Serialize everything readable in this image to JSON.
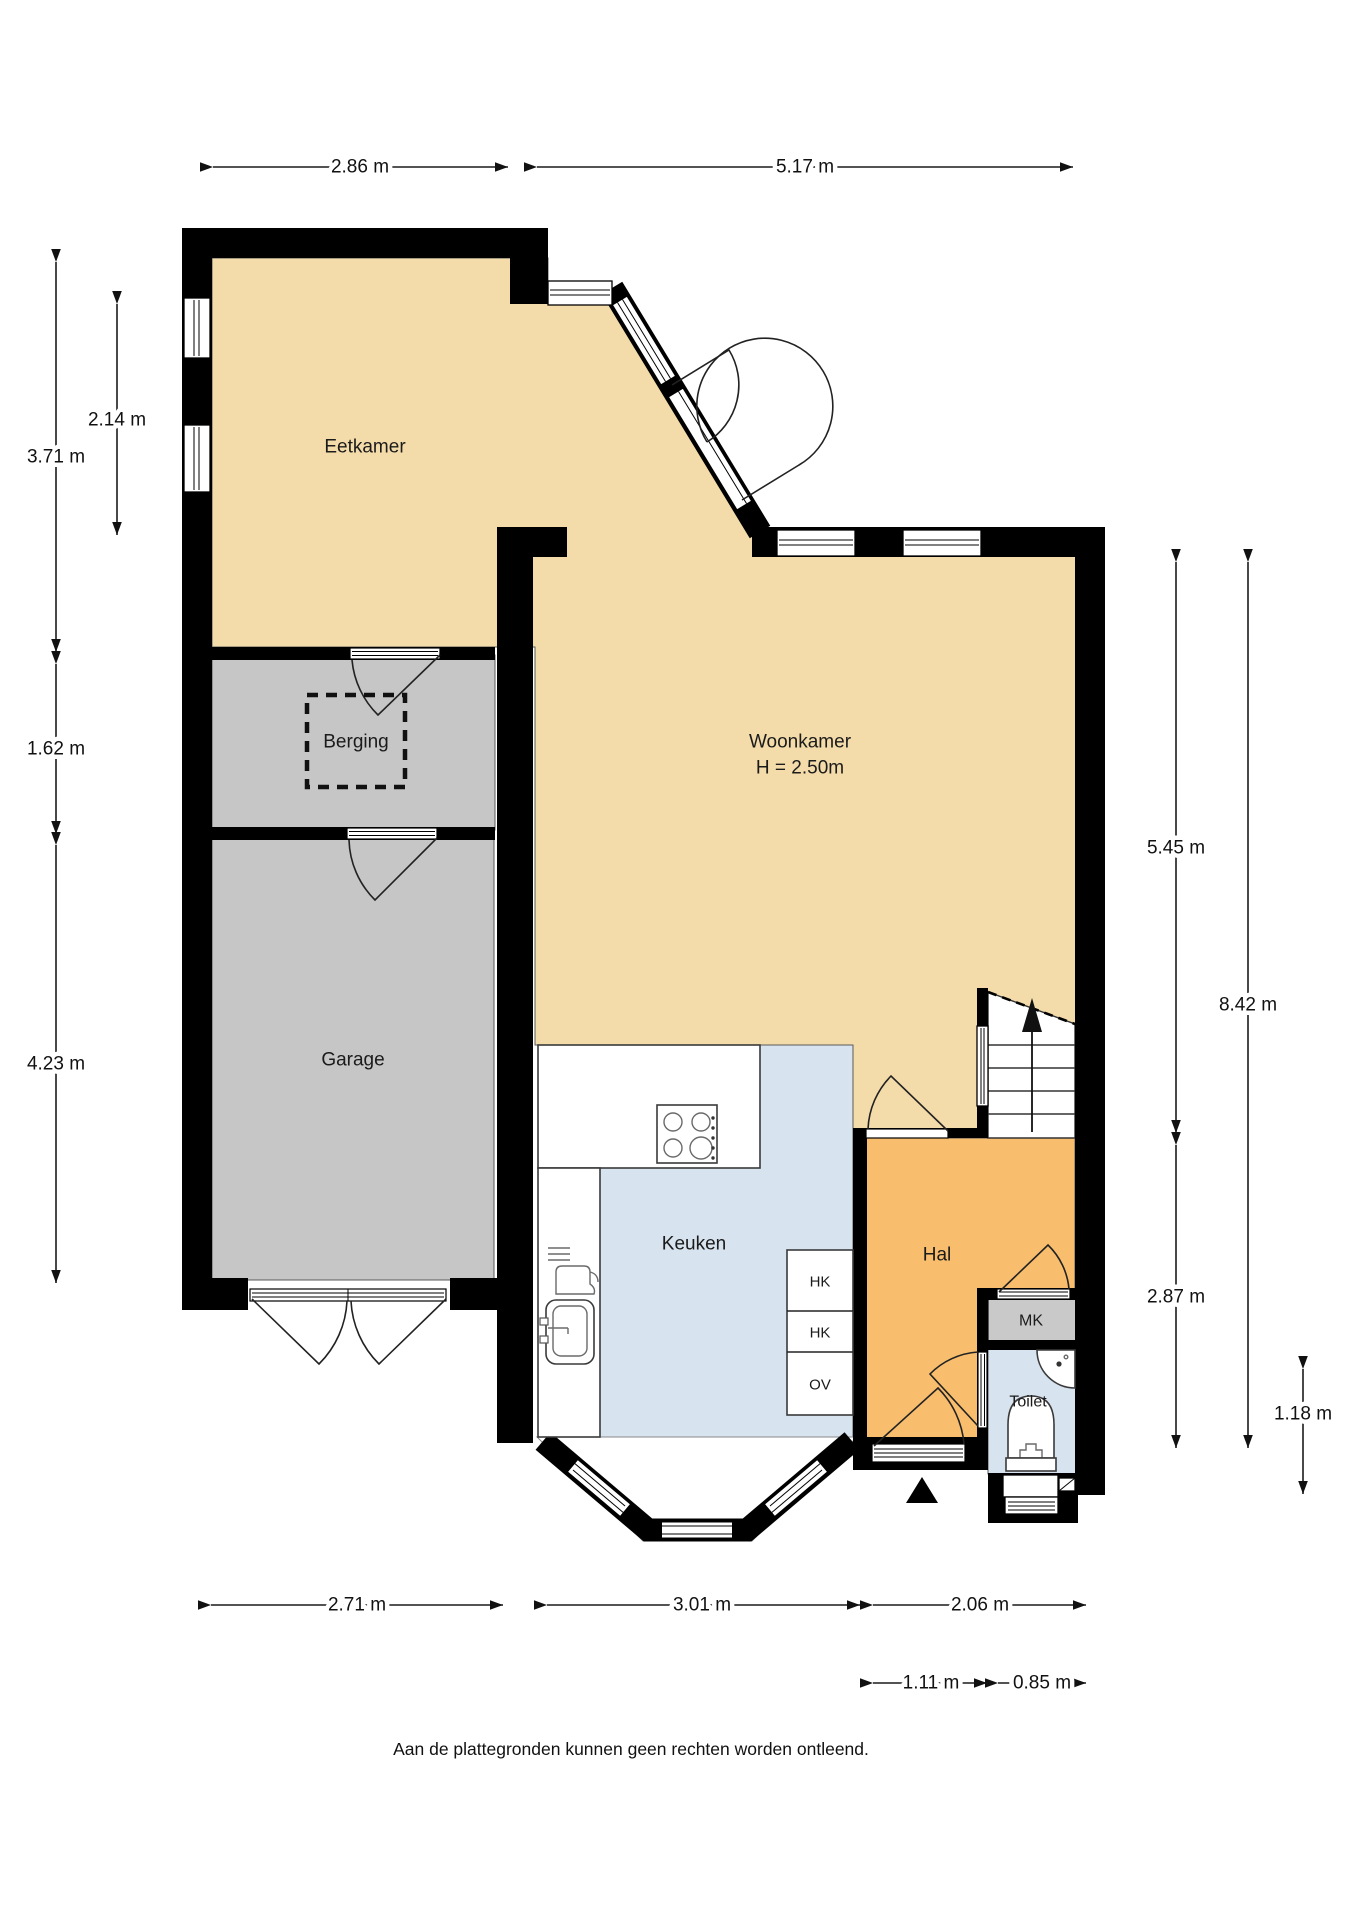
{
  "plan": {
    "rooms": {
      "eetkamer": "Eetkamer",
      "woonkamer": "Woonkamer",
      "woonkamer_ceiling": "H = 2.50m",
      "berging": "Berging",
      "garage": "Garage",
      "keuken": "Keuken",
      "hal": "Hal",
      "mk": "MK",
      "toilet": "Toilet",
      "closets": [
        "HK",
        "HK",
        "OV"
      ]
    },
    "dimensions": {
      "top": [
        "2.86 m",
        "5.17 m"
      ],
      "left": [
        "3.71 m",
        "2.14 m",
        "1.62 m",
        "4.23 m"
      ],
      "right": [
        "5.45 m",
        "8.42 m",
        "2.87 m",
        "1.18 m"
      ],
      "bottom_row1": [
        "2.71 m",
        "3.01 m",
        "2.06 m"
      ],
      "bottom_row2": [
        "1.11 m",
        "0.85 m"
      ]
    },
    "footer": "Aan de plattegronden kunnen geen rechten worden ontleend.",
    "colors": {
      "wall": "#000000",
      "floor_tan": "#F4DCAA",
      "floor_gray": "#C6C6C6",
      "floor_blue": "#D7E3EF",
      "floor_orange": "#F8BE6E",
      "floor_mk": "#C9C9C9"
    }
  }
}
